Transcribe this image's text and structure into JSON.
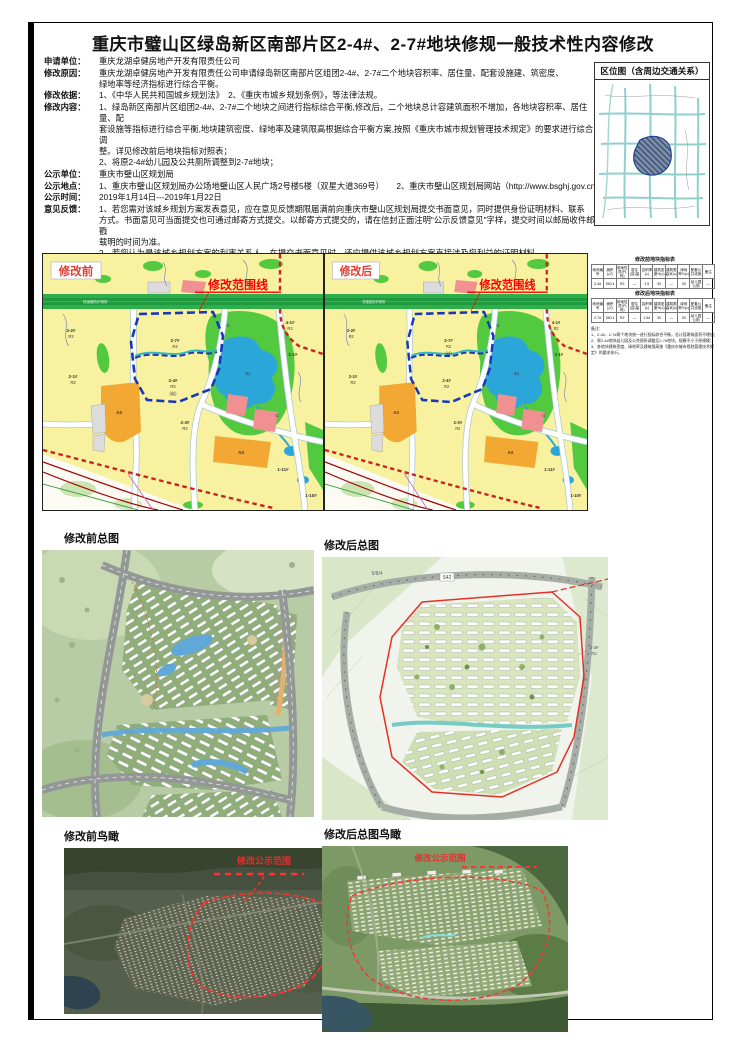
{
  "title": "重庆市璧山区绿岛新区南部片区2-4#、2-7#地块修规一般技术性内容修改",
  "info": {
    "rows": [
      {
        "label": "申请单位：",
        "value": "重庆龙湖卓健房地产开发有限责任公司"
      },
      {
        "label": "修改原因：",
        "value": "重庆龙湖卓健房地产开发有限责任公司申请绿岛新区南部片区组团2-4#、2-7#二个地块容积率、居住量、配套设施建、筑密度、\n绿地率等经济指标进行综合平衡。"
      },
      {
        "label": "修改依据：",
        "value": "1、《中华人民共和国城乡规划法》　2、《重庆市城乡规划条例》，等法律法规。"
      },
      {
        "label": "修改内容：",
        "value": "1、绿岛新区南部片区组团2-4#、2-7#二个地块之间进行指标综合平衡,修改后，二个地块总计容建筑面积不增加，各地块容积率、居住量、配\n套设施等指标进行综合平衡,地块建筑密度、绿地率及建筑限高根据综合平衡方案,按照《重庆市城市规划管理技术规定》的要求进行综合调\n整。详见修改前后地块指标对照表；\n2、将原2-4#幼儿园及公共厕所调整到2-7#地块；"
      },
      {
        "label": "公示单位：",
        "value": "重庆市璧山区规划局"
      },
      {
        "label": "公示地点：",
        "value": "1、重庆市璧山区规划局办公场地璧山区人民广场2号楼5楼（双星大道369号）　　2、重庆市璧山区规划局网站（http://www.bsghj.gov.cn）"
      },
      {
        "label": "公示时间：",
        "value": "2019年1月14日---2019年1月22日"
      },
      {
        "label": "意见反馈：",
        "value": "1、若您需对该城乡规划方案发表意见，应在意见反馈期限届满前向重庆市璧山区规划局提交书面意见，同时提供身份证明材料、联系\n方式。书面意见可当面提交也可通过邮寄方式提交。以邮寄方式提交的，请在信封正面注明\"公示反馈意见\"字样，提交时间以邮局收件邮戳\n载明的时间为准。\n2、若您认为是该城乡规划方案的利害关系人，在提交书面意见时，还应提供该城乡规划方案直接涉及您利益的证明材料。\n3、意见反馈期限截止至公示期届满后5个工作日内。规定期限内未反馈意见的，视为放弃权利。\n通信地址：重庆市璧山区双星大道369号2号楼　　　　　　联系人：孙老师　联系电话：023-41421538"
      }
    ]
  },
  "sections": {
    "vicinity_title": "区位图（含周边交通关系）",
    "map_before": "修改前",
    "map_after": "修改后",
    "scope_line": "修改范围线",
    "siteplan_before": "修改前总图",
    "siteplan_after": "修改后总图",
    "aerial_before": "修改前鸟瞰",
    "aerial_after": "修改后总图鸟瞰",
    "aerial_scope": "修改公示范围"
  },
  "parcels": {
    "p27": "2-7#",
    "p24": "2-4#",
    "p22": "2-2#",
    "p21": "2-1#",
    "p23": "2-3#",
    "p41": "4-1#",
    "p11": "1-1#",
    "p111": "1-11#",
    "p110": "1-10#",
    "r2": "R2",
    "a3": "A3",
    "e1": "E1",
    "g": "G",
    "band": "快速路防护绿带",
    "kinder": "(幼)"
  },
  "siteplan_labels": {
    "s42": "S42",
    "block": "5/8/4",
    "p23": "2-3#",
    "r2": "R2"
  },
  "tables": {
    "before": {
      "title": "修改前地块指标表",
      "headers": [
        "地块编号",
        "面积(㎡)",
        "用地性质(代码)",
        "居住(容)量",
        "容积率(≤)",
        "建筑密度%(≤)",
        "建筑限高米(≤)",
        "绿地率%(≥)",
        "配套公共设施",
        "备注"
      ],
      "row": [
        "2-4#",
        "250.4",
        "R2",
        "—",
        "1.5",
        "30",
        "—",
        "30",
        "幼儿园 公厕",
        "—"
      ]
    },
    "after": {
      "title": "修改后地块指标表",
      "headers": [
        "地块编号",
        "面积(㎡)",
        "用地性质(代码)",
        "居住(容)量",
        "容积率(≤)",
        "建筑密度%(≤)",
        "建筑限高米(≤)",
        "绿地率%(≥)",
        "配套公共设施",
        "备注"
      ],
      "row": [
        "2-7#",
        "250.4",
        "R2",
        "—",
        "1.54",
        "30",
        "—",
        "30",
        "幼儿园 公厕",
        "—"
      ]
    },
    "notes": [
      "备注：",
      "1、2-4#、2-7#两个地块统一进行指标综合平衡，总计容建筑面积不增加；",
      "2、原2-4#地块幼儿园及公共厕所调整至2-7#地块，规模不小于原规模；",
      "3、各地块建筑密度、绿地率及建筑限高按《重庆市城市规划管理技术规定》的要求执行。"
    ]
  },
  "colors": {
    "accent_red": "#ff0000",
    "boundary_blue": "#1838b8",
    "park_green": "#52c93f",
    "water_blue": "#2aa7d8",
    "parcel_yellow": "#f7f1a0",
    "commercial_orange": "#f3a833",
    "public_pink": "#f09090",
    "band_green": "#2faf4b"
  }
}
